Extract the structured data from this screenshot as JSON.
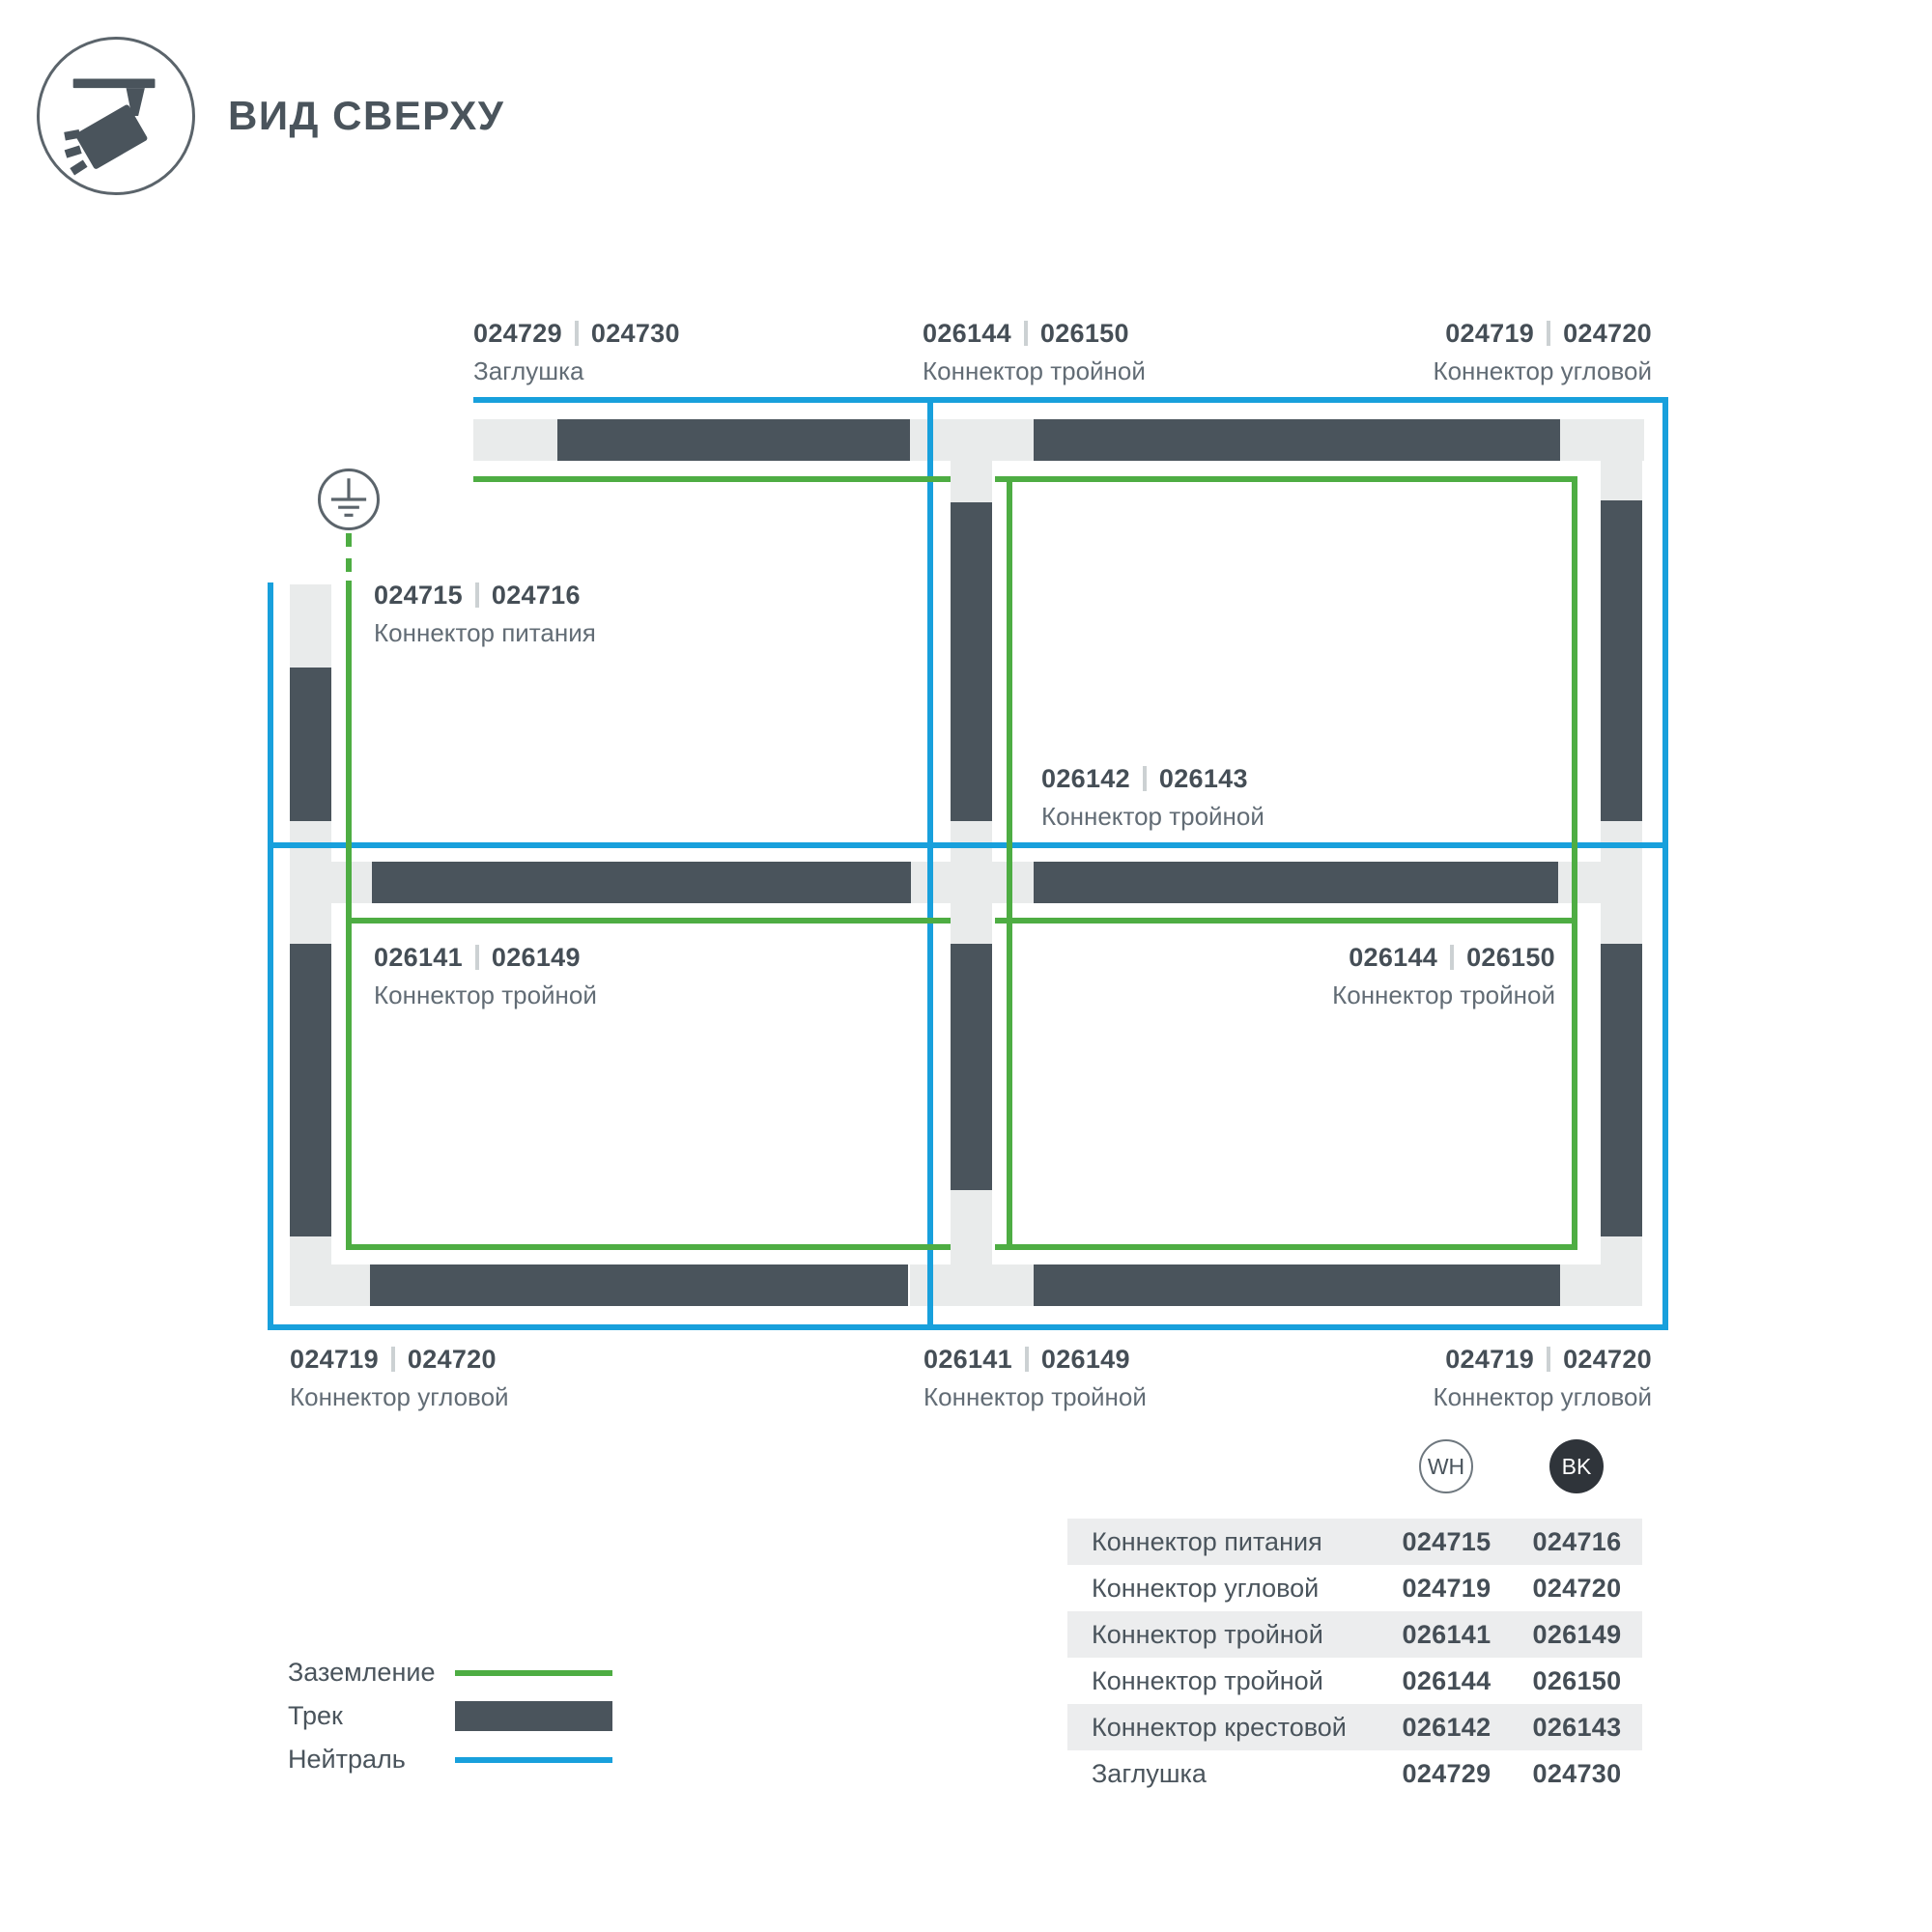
{
  "header": {
    "title": "ВИД СВЕРХУ"
  },
  "colors": {
    "track": "#4a545c",
    "connector": "#e9ebeb",
    "neutral": "#18a0dc",
    "ground": "#4ead43"
  },
  "diagram": {
    "labels": [
      {
        "wh": "024729",
        "bk": "024730",
        "name": "Заглушка"
      },
      {
        "wh": "026144",
        "bk": "026150",
        "name": "Коннектор тройной"
      },
      {
        "wh": "024719",
        "bk": "024720",
        "name": "Коннектор угловой"
      },
      {
        "wh": "024715",
        "bk": "024716",
        "name": "Коннектор питания"
      },
      {
        "wh": "026142",
        "bk": "026143",
        "name": "Коннектор тройной"
      },
      {
        "wh": "026141",
        "bk": "026149",
        "name": "Коннектор тройной"
      },
      {
        "wh": "026144",
        "bk": "026150",
        "name": "Коннектор тройной"
      },
      {
        "wh": "024719",
        "bk": "024720",
        "name": "Коннектор угловой"
      },
      {
        "wh": "026141",
        "bk": "026149",
        "name": "Коннектор тройной"
      },
      {
        "wh": "024719",
        "bk": "024720",
        "name": "Коннектор угловой"
      }
    ]
  },
  "legend": {
    "items": [
      {
        "label": "Заземление"
      },
      {
        "label": "Трек"
      },
      {
        "label": "Нейтраль"
      }
    ]
  },
  "table": {
    "columns": [
      "WH",
      "BK"
    ],
    "rows": [
      {
        "name": "Коннектор питания",
        "wh": "024715",
        "bk": "024716"
      },
      {
        "name": "Коннектор угловой",
        "wh": "024719",
        "bk": "024720"
      },
      {
        "name": "Коннектор тройной",
        "wh": "026141",
        "bk": "026149"
      },
      {
        "name": "Коннектор тройной",
        "wh": "026144",
        "bk": "026150"
      },
      {
        "name": "Коннектор крестовой",
        "wh": "026142",
        "bk": "026143"
      },
      {
        "name": "Заглушка",
        "wh": "024729",
        "bk": "024730"
      }
    ]
  }
}
